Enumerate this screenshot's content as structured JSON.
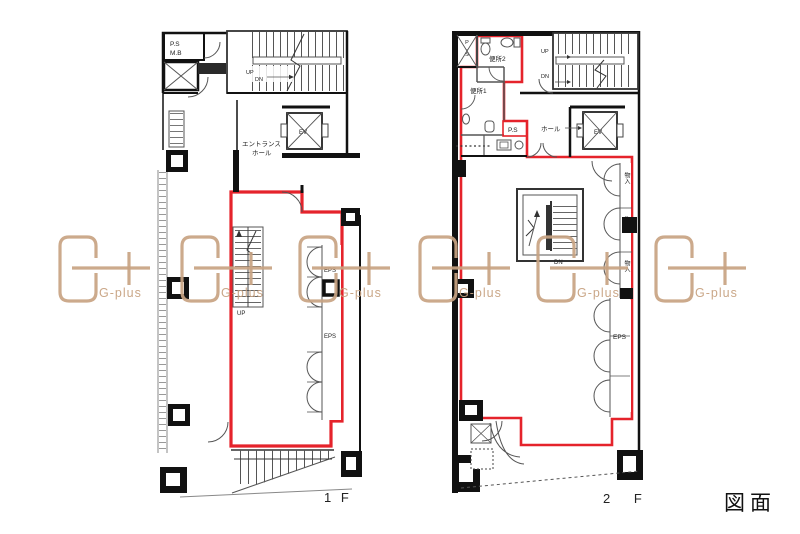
{
  "page": {
    "caption": "図面",
    "background": "#ffffff"
  },
  "watermark": {
    "brand": "G-plus",
    "color": "#c8a382"
  },
  "colors": {
    "leased_outline_red": "#e5232b",
    "leased_fill_lavender": "#d7dae7",
    "wall_black": "#111111",
    "line_gray": "#555555"
  },
  "plan_1f": {
    "floor_label": "1 F",
    "labels": {
      "ps": "P.S",
      "mb": "M.B",
      "stair_up": "UP",
      "stair_dn": "DN",
      "elevator": "EV",
      "entrance_line1": "エントランス",
      "entrance_line2": "ホール",
      "inner_stair_up": "UP",
      "eps_upper": "EPS",
      "eps_lower": "EPS"
    }
  },
  "plan_2f": {
    "floor_label": "2 F",
    "labels": {
      "ps_shaft": "P.S",
      "toilet2": "便所2",
      "toilet1": "便所1",
      "stair_up": "UP",
      "stair_dn": "DN",
      "ps_box": "P.S",
      "hall": "ホール",
      "elevator": "EV",
      "storage1": "物入",
      "storage2": "物入",
      "storage3": "物入",
      "inner_stair_dn": "DN",
      "eps": "EPS"
    }
  }
}
